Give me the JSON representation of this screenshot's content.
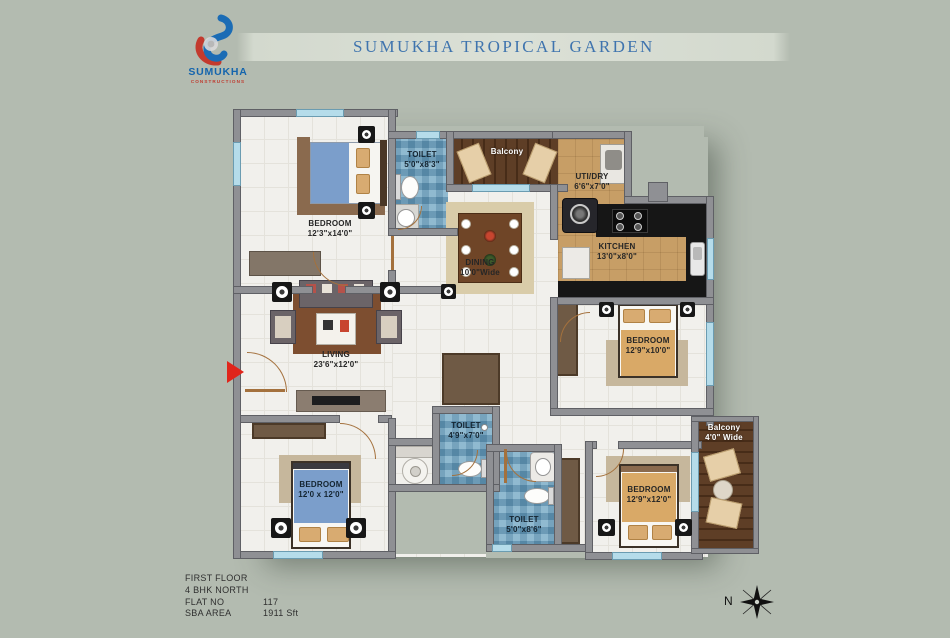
{
  "header": {
    "logo": {
      "brand": "SUMUKHA",
      "sub": "CONSTRUCTIONS"
    },
    "title": "SUMUKHA TROPICAL GARDEN"
  },
  "plan": {
    "rooms": [
      {
        "id": "bedroom-top-left",
        "name": "BEDROOM",
        "dims": "12'3\"x14'0\""
      },
      {
        "id": "toilet-top",
        "name": "TOILET",
        "dims": "5'0\"x8'3\""
      },
      {
        "id": "balcony-top",
        "name": "Balcony",
        "dims": ""
      },
      {
        "id": "utility",
        "name": "UTI/DRY",
        "dims": "6'6\"x7'0\""
      },
      {
        "id": "kitchen",
        "name": "KITCHEN",
        "dims": "13'0\"x8'0\""
      },
      {
        "id": "dining",
        "name": "DINING",
        "dims": "10'0\"Wide"
      },
      {
        "id": "living",
        "name": "LIVING",
        "dims": "23'6\"x12'0\""
      },
      {
        "id": "bedroom-right",
        "name": "BEDROOM",
        "dims": "12'9\"x10'0\""
      },
      {
        "id": "bedroom-bottom-left",
        "name": "BEDROOM",
        "dims": "12'0 x 12'0\""
      },
      {
        "id": "toilet-middle",
        "name": "TOILET",
        "dims": "4'9\"x7'0\""
      },
      {
        "id": "toilet-bottom",
        "name": "TOILET",
        "dims": "5'0\"x8'6\""
      },
      {
        "id": "bedroom-bottom-right",
        "name": "BEDROOM",
        "dims": "12'9\"x12'0\""
      },
      {
        "id": "balcony-right",
        "name": "Balcony",
        "dims": "4'0\" Wide"
      }
    ]
  },
  "footer": {
    "rows": [
      {
        "label": "FIRST FLOOR",
        "value": ""
      },
      {
        "label": "4 BHK NORTH",
        "value": ""
      },
      {
        "label": "FLAT NO",
        "value": "117"
      },
      {
        "label": "SBA  AREA",
        "value": "1911 Sft"
      }
    ],
    "compass": "N"
  },
  "colors": {
    "background": "#b3bbb0",
    "title_blue": "#3f74ae",
    "logo_blue": "#1b6cb5",
    "logo_red": "#c33a2e",
    "wall_gray": "#8f9094",
    "tile_blue": "#79abc7",
    "balcony_wood": "#5e3e26",
    "kitchen_tan": "#c79e66",
    "entry_arrow_red": "#e0251b"
  }
}
